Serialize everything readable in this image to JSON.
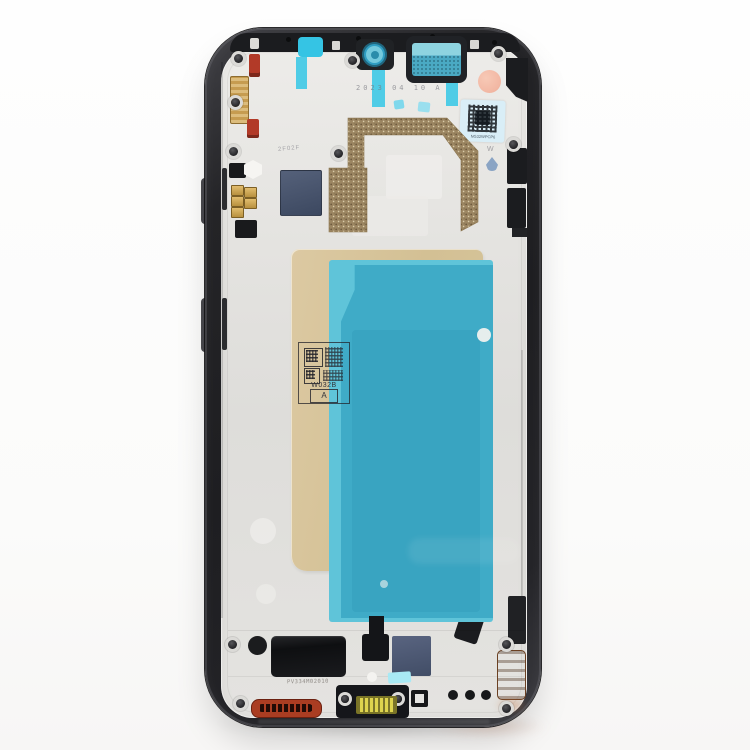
{
  "meta": {
    "description": "Product photo: black front housing LCD frame middle bezel plate for a smartphone, shown face-up on a white background with teal protective films, gold backing paper, QR labels and bottom components"
  },
  "stamps": {
    "date_code": "2023 04 10 A",
    "mid_code": "2F02F",
    "wm_mark": "W",
    "label_code": "W032B",
    "label_grade": "A",
    "bottom_code": "PV334M02010",
    "qr_sticker_microtext": "NG32WPCP6"
  },
  "parts": {
    "frame": "black-middle-frame",
    "plate": "silver-inner-plate",
    "film": "teal-protective-film",
    "paper": "gold-backing-paper",
    "camera": "front-camera-hole",
    "earpiece": "earpiece-speaker-cutout",
    "sticker": "qr-code-sticker",
    "grille": "red-loudspeaker-grille",
    "connector": "yellow-board-connector",
    "coil": "copper-antenna-contact"
  },
  "colors": {
    "frame": "#242427",
    "plate": "#e4e3e0",
    "plate_hi": "#edecE9",
    "film": "#3fabc7",
    "film_light": "#5fc4d9",
    "film_inner": "#38a3c0",
    "tape": "#35c4e4",
    "paper": "#d3c094",
    "bronze": "#9c8662",
    "slate": "#4b5870",
    "gold": "#c9a44e",
    "red_clip": "#b23a28",
    "red_grille": "#aa3d22",
    "yellow": "#ded44e",
    "copper": "#a97a4e",
    "pink": "#f2b7a3",
    "sticker_bg": "#d9eef7",
    "black_part": "#17181a",
    "stamp_ink": "#33333a"
  }
}
